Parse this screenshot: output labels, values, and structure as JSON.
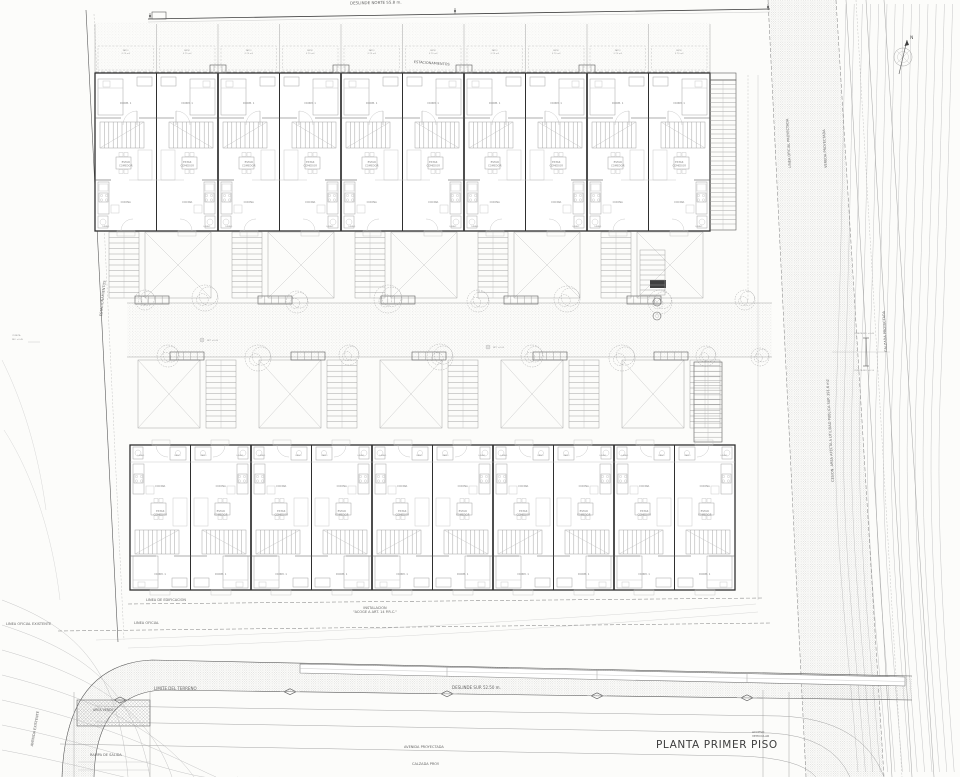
{
  "title_block": {
    "title": "PLANTA PRIMER PISO"
  },
  "boundary_labels": {
    "deslinde_norte": "DESLINDE NORTE 55.8 m.",
    "deslinde_sur": "DESLINDE SUR 52.50 m.",
    "linea_oficial_existente": "LINEA OFICIAL EXISTENTE",
    "linea_oficial": "LINEA OFICIAL",
    "linea_edificacion": "LINEA DE EDIFICACION",
    "limite_terreno": "LIMITE DEL TERRENO"
  },
  "street_labels": {
    "avenida_existente": "AVENIDA EXISTENTE",
    "avenida_proyectada": "AVENIDA PROYECTADA",
    "calzada_proy": "CALZADA PROY.",
    "rampa_salida": "RAMPA DE SALIDA",
    "acceso_vehicular": "ACCESO VEHICULAR",
    "linea_oficial_proyectada": "LINEA OFICIAL PROYECTADA",
    "vereda_proyectada": "VEREDA PROYECTADA",
    "calzada_proyectada": "CALZADA PROYECTADA",
    "cesion": "CESION. AREA AFECTA A UTILIDAD PUBLICA SUP. 391.6 m2",
    "estacionamientos": "ESTACIONAMIENTOS",
    "area_verde": "AREA VERDE"
  },
  "annotations": {
    "instalacion_1": "INSTALACION",
    "instalacion_2": "\"ACOGE A ART. 14 P.R.C.\"",
    "cuneta": "CUNETA",
    "nivel_sup": "NIV. +0.45",
    "nivel_inf": "NIV. +0.15",
    "nivel_patio": "NPT +0.00",
    "north": "N"
  },
  "rooms": {
    "bedroom": "DORM. 1",
    "living_1": "ESTAR",
    "living_2": "COMEDOR",
    "kitchen": "COCINA",
    "laundry": "LAVAD.",
    "bath": "BAÑO",
    "patio_1": "PATIO",
    "patio_2": "3.75 m2"
  },
  "plan": {
    "units_upper": 10,
    "units_lower": 10,
    "upper_block": {
      "x": 95,
      "y": 73,
      "w": 615,
      "h": 158
    },
    "lower_block": {
      "x": 130,
      "y": 445,
      "w": 605,
      "h": 145
    },
    "courtyard": {
      "x": 127,
      "y": 303,
      "w": 645,
      "h": 54
    }
  },
  "colors": {
    "paper": "#fcfcfa",
    "ink": "#3a3a3a",
    "light": "#9a9a9a",
    "contour": "#c6c6c6"
  }
}
